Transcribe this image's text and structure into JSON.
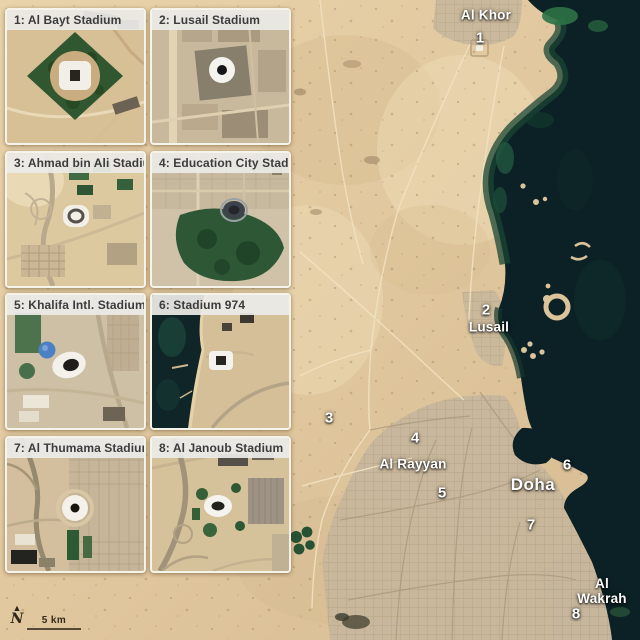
{
  "panels": [
    {
      "title": "1: Al Bayt Stadium"
    },
    {
      "title": "2: Lusail Stadium"
    },
    {
      "title": "3: Ahmad bin Ali Stadium"
    },
    {
      "title": "4: Education City Stadium"
    },
    {
      "title": "5: Khalifa Intl. Stadium"
    },
    {
      "title": "6: Stadium 974"
    },
    {
      "title": "7: Al Thumama Stadium"
    },
    {
      "title": "8: Al Janoub Stadium"
    }
  ],
  "map": {
    "labels": [
      {
        "name": "al-khor",
        "text": "Al Khor"
      },
      {
        "name": "lusail",
        "text": "Lusail"
      },
      {
        "name": "al-rayyan",
        "text": "Al Rayyan"
      },
      {
        "name": "doha",
        "text": "Doha"
      },
      {
        "name": "al-wakrah",
        "text": "Al Wakrah"
      }
    ],
    "markers": [
      {
        "n": "1"
      },
      {
        "n": "2"
      },
      {
        "n": "3"
      },
      {
        "n": "4"
      },
      {
        "n": "5"
      },
      {
        "n": "6"
      },
      {
        "n": "7"
      },
      {
        "n": "8"
      }
    ],
    "compass": {
      "label": "N",
      "arrow": "▲"
    },
    "scale_bar": {
      "label": "5 km"
    },
    "colors": {
      "sea": "#0c2125",
      "shallow_green": "#1a4634",
      "sand": "#e0c69d",
      "urban": "#c6b69c",
      "label_text": "#ffffff",
      "panel_header_bg": "#ecebE7",
      "panel_header_text": "#3c3c3c"
    }
  }
}
